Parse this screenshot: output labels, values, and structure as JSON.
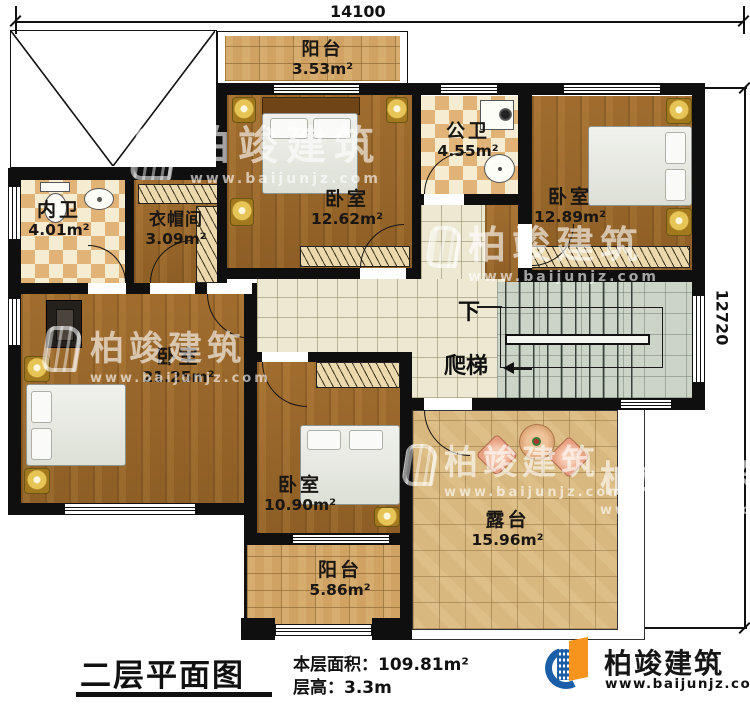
{
  "dimensions": {
    "width_mm": "14100",
    "height_mm": "12720"
  },
  "plan": {
    "rooms": [
      {
        "key": "balcony-top",
        "name": "阳台",
        "area": "3.53m²"
      },
      {
        "key": "bedroom-top-left",
        "name": "卧室",
        "area": "12.62m²"
      },
      {
        "key": "bath-public",
        "name": "公卫",
        "area": "4.55m²"
      },
      {
        "key": "bedroom-top-right",
        "name": "卧室",
        "area": "12.89m²"
      },
      {
        "key": "bath-ensuite",
        "name": "内卫",
        "area": "4.01m²"
      },
      {
        "key": "cloakroom",
        "name": "衣帽间",
        "area": "3.09m²"
      },
      {
        "key": "bedroom-master",
        "name": "卧室",
        "area": "21.25m²"
      },
      {
        "key": "bedroom-bottom",
        "name": "卧室",
        "area": "10.90m²"
      },
      {
        "key": "balcony-bottom",
        "name": "阳台",
        "area": "5.86m²"
      },
      {
        "key": "terrace",
        "name": "露台",
        "area": "15.96m²"
      }
    ],
    "stairs": {
      "down": "下",
      "ladder": "爬梯"
    }
  },
  "footer": {
    "title": "二层平面图",
    "area_label": "本层面积：",
    "area_value": "109.81m²",
    "height_label": "层高：",
    "height_value": "3.3m"
  },
  "brand": {
    "name": "柏竣建筑",
    "site": "www.baijunjz.com"
  },
  "watermark": {
    "name": "柏竣建筑",
    "site": "www.baijunjz.com"
  },
  "colors": {
    "wall": "#0f0f0f",
    "wood": "#9a672c",
    "tile_cream": "#ece8d2",
    "tile_stair": "#cbd4c7",
    "tile_balcony": "#d0a263",
    "tile_terrace": "#d8b87e",
    "checker_dark": "#e2b377",
    "checker_light": "#f6ecd2",
    "brand_blue": "#1b5ea8",
    "brand_orange": "#f7941d"
  }
}
